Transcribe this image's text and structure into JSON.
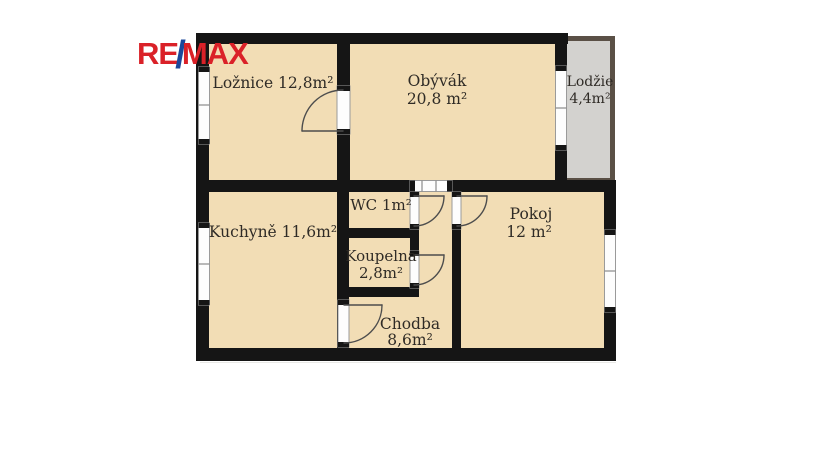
{
  "logo": {
    "re": "RE",
    "slash": "/",
    "max": "MAX"
  },
  "colors": {
    "remax_red": "#DA2128",
    "remax_blue": "#1B489B",
    "floor_tan": "#F2DDB5",
    "wall_black": "#151515",
    "loggia_fill": "#D3D2CF",
    "loggia_border": "#5A5046"
  },
  "floorplan": {
    "rooms": {
      "loznice": {
        "label": "Ložnice 12,8m²"
      },
      "obyvak": {
        "name": "Obývák",
        "area": "20,8 m²"
      },
      "lodzie": {
        "name": "Lodžie",
        "area": "4,4m²"
      },
      "kuchyne": {
        "label": "Kuchyně 11,6m²"
      },
      "wc": {
        "label": "WC 1m²"
      },
      "koupelna": {
        "name": "Koupelna",
        "area": "2,8m²"
      },
      "pokoj": {
        "name": "Pokoj",
        "area": "12 m²"
      },
      "chodba": {
        "name": "Chodba",
        "area": "8,6m²"
      }
    }
  }
}
